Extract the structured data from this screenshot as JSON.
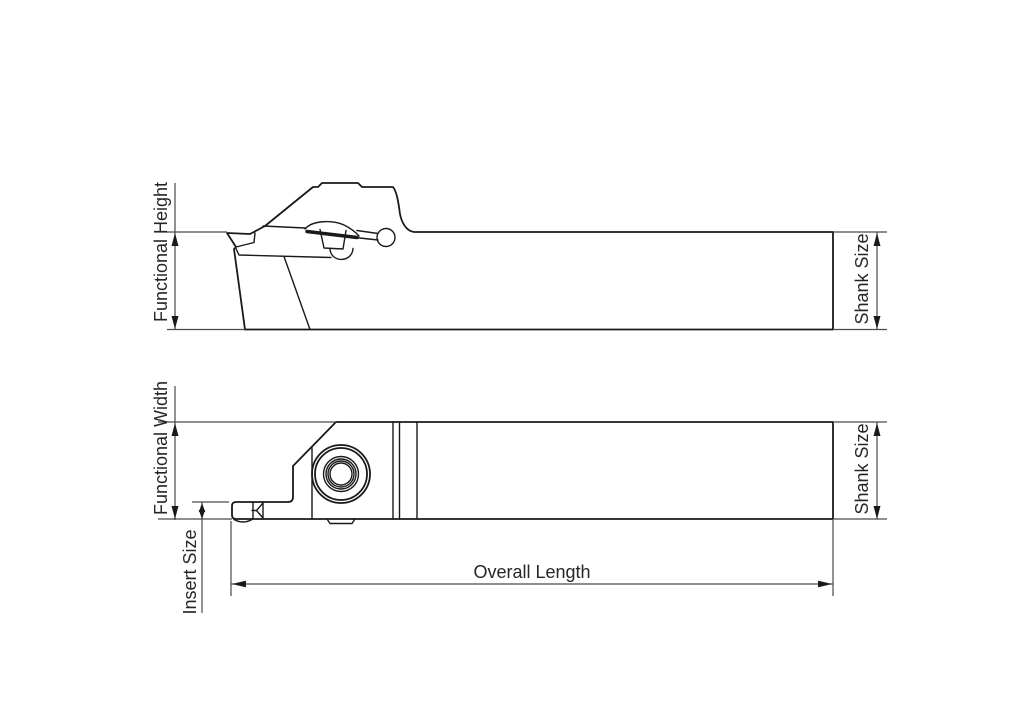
{
  "drawing": {
    "description": "Two-view engineering line drawing of a parting and grooving tool holder with dimension callouts",
    "views": {
      "side": {
        "labels": {
          "functional_height": "Functional Height",
          "shank_size": "Shank Size"
        }
      },
      "plan": {
        "labels": {
          "functional_width": "Functional Width",
          "shank_size": "Shank Size",
          "insert_size": "Insert Size",
          "overall_length": "Overall Length"
        }
      }
    },
    "colors": {
      "background": "#ffffff",
      "outline": "#1a1a1a",
      "dimension_line": "#4a4a4a",
      "label_text": "#262626"
    }
  }
}
